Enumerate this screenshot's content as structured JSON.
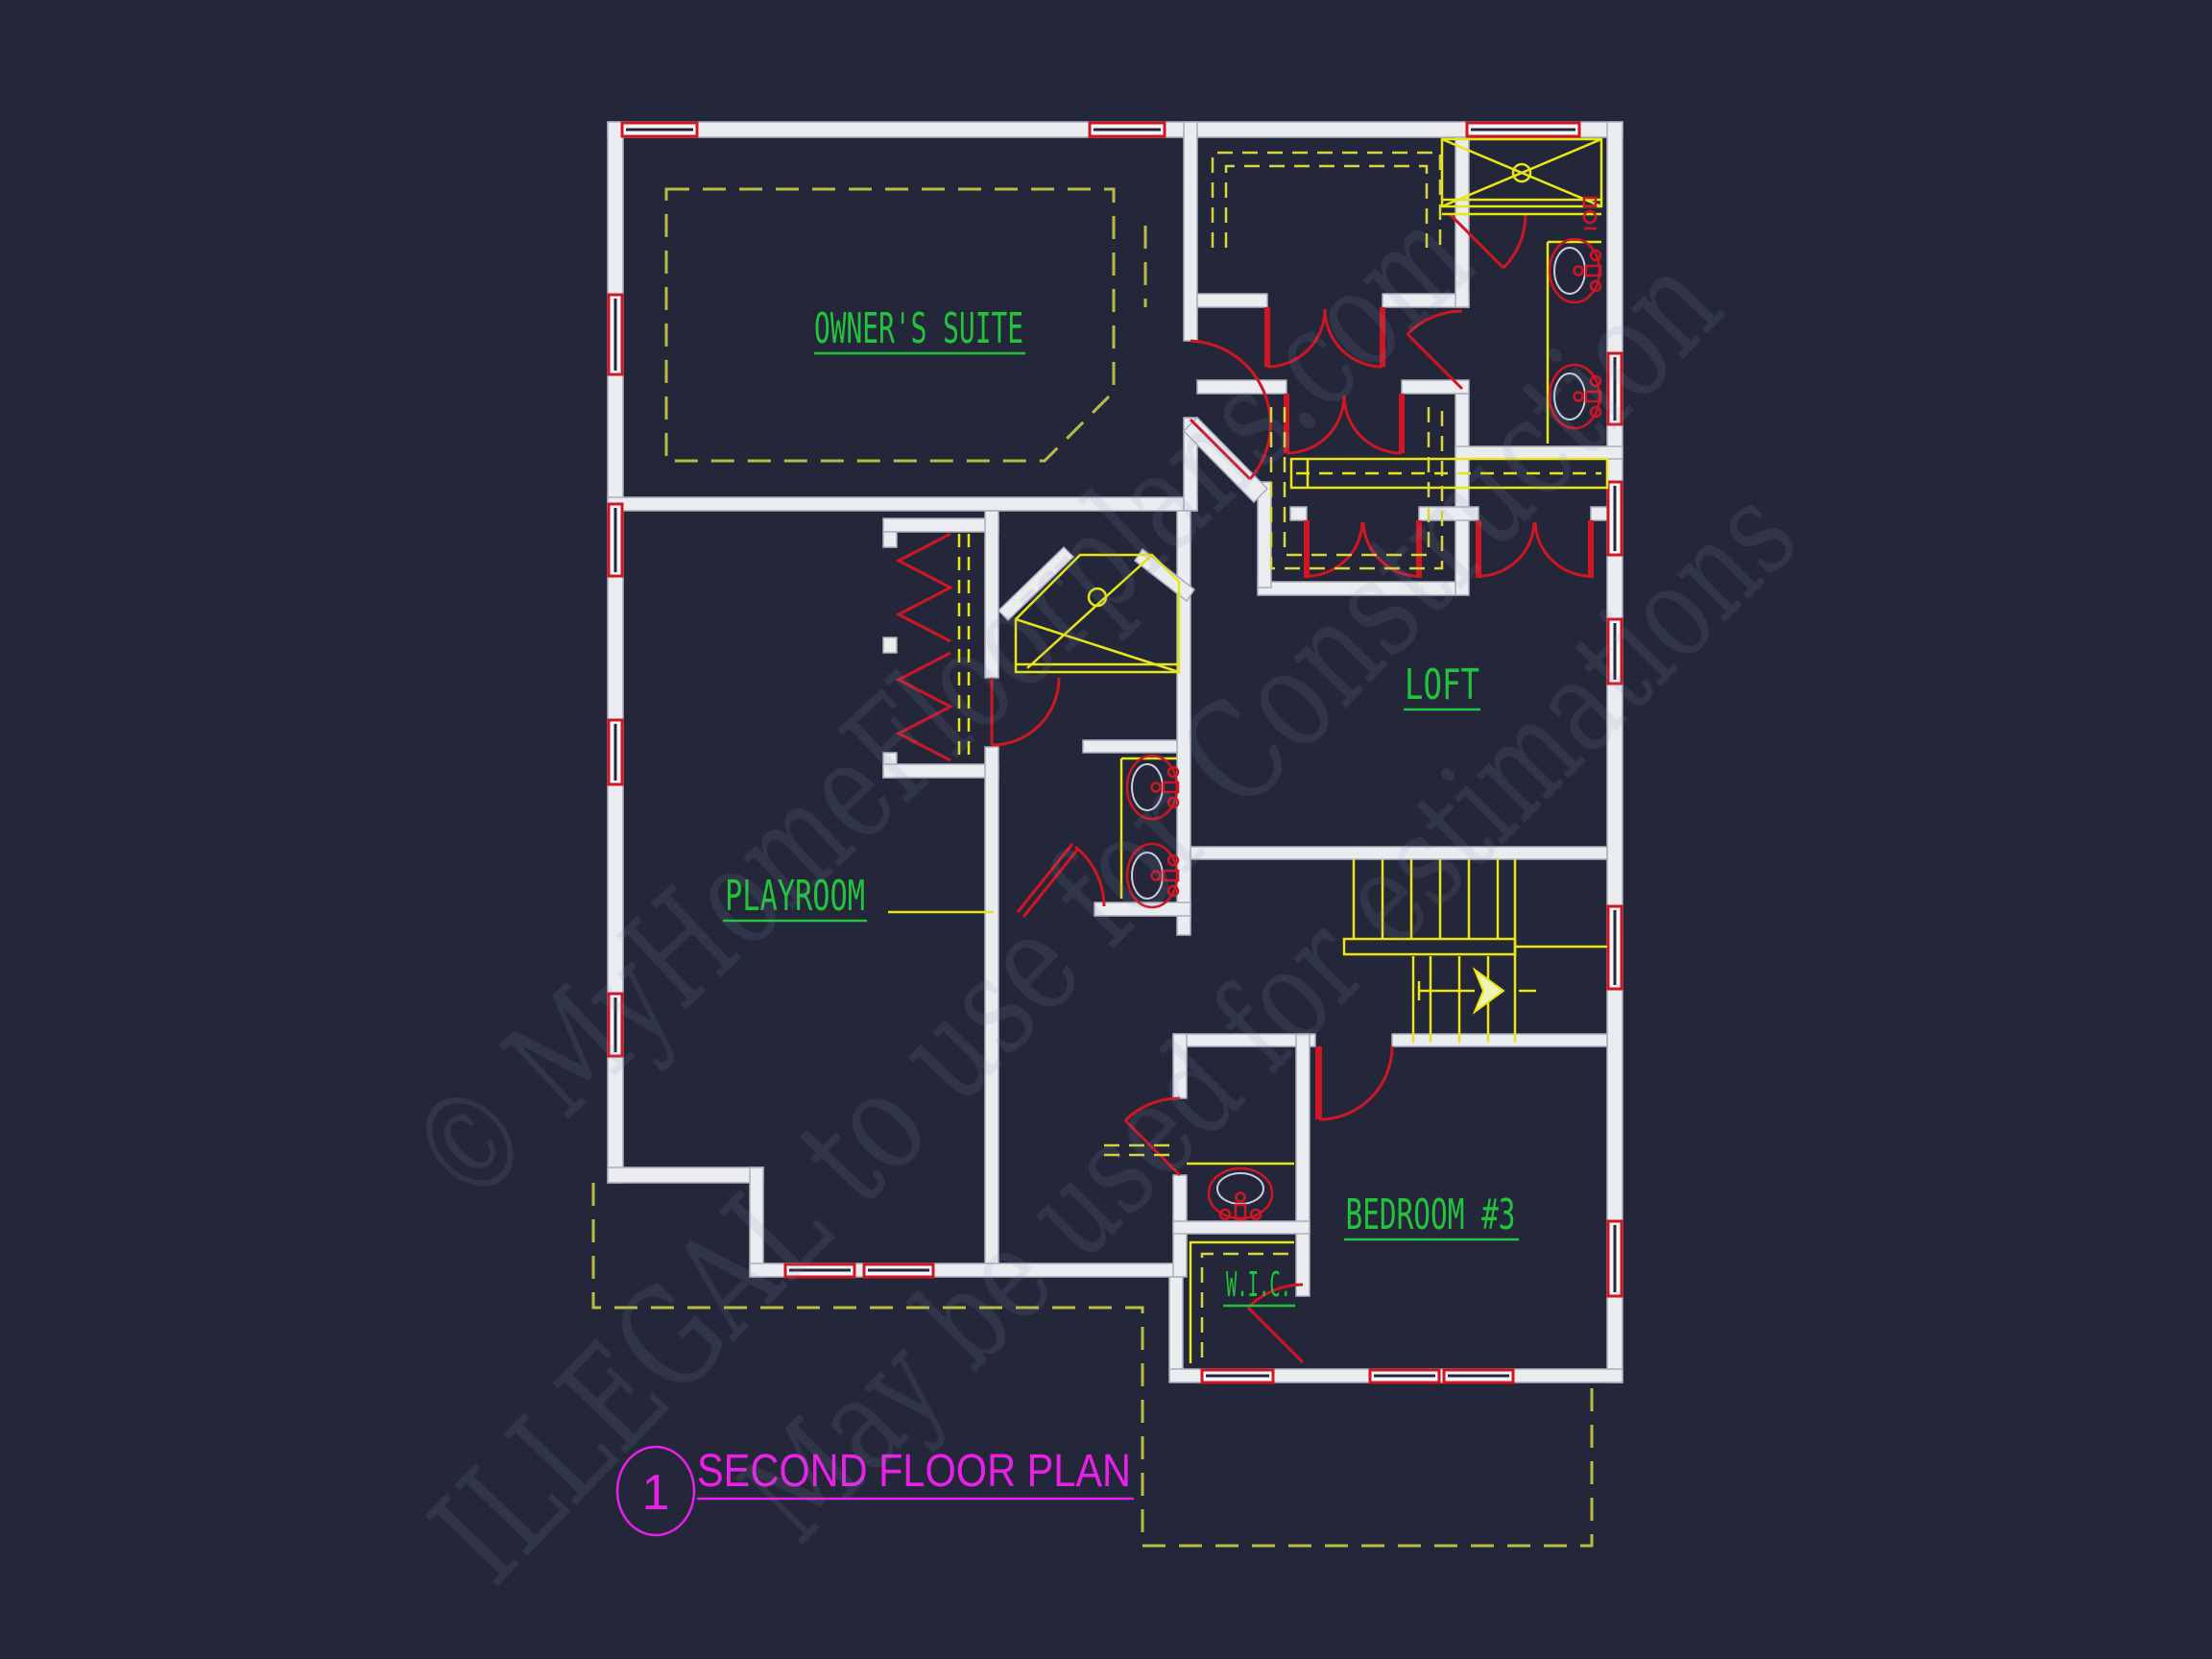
{
  "page": {
    "background": "#242739",
    "drawing_type": "architectural floor plan"
  },
  "title_block": {
    "sheet_number": "1",
    "title": "SECOND FLOOR PLAN",
    "color": "#ea1fe8"
  },
  "rooms": {
    "owners_suite": {
      "label": "OWNER'S SUITE"
    },
    "loft": {
      "label": "LOFT"
    },
    "playroom": {
      "label": "PLAYROOM"
    },
    "bedroom_3": {
      "label": "BEDROOM #3"
    },
    "wic": {
      "label": "W.I.C."
    }
  },
  "watermark": {
    "line1": "© MyHomeFloorplans.com",
    "line2": "ILLEGAL to use for Construction",
    "line3": "May be used for estimations"
  },
  "legend_colors": {
    "walls": "#ebecf0",
    "doors_and_windows": "#d01622",
    "fixtures_and_stairs": "#e8e613",
    "ceiling_roof_dashed": "#b9bd41",
    "room_labels": "#22c43b",
    "title": "#ea1fe8",
    "watermark": "#8a93c0"
  }
}
